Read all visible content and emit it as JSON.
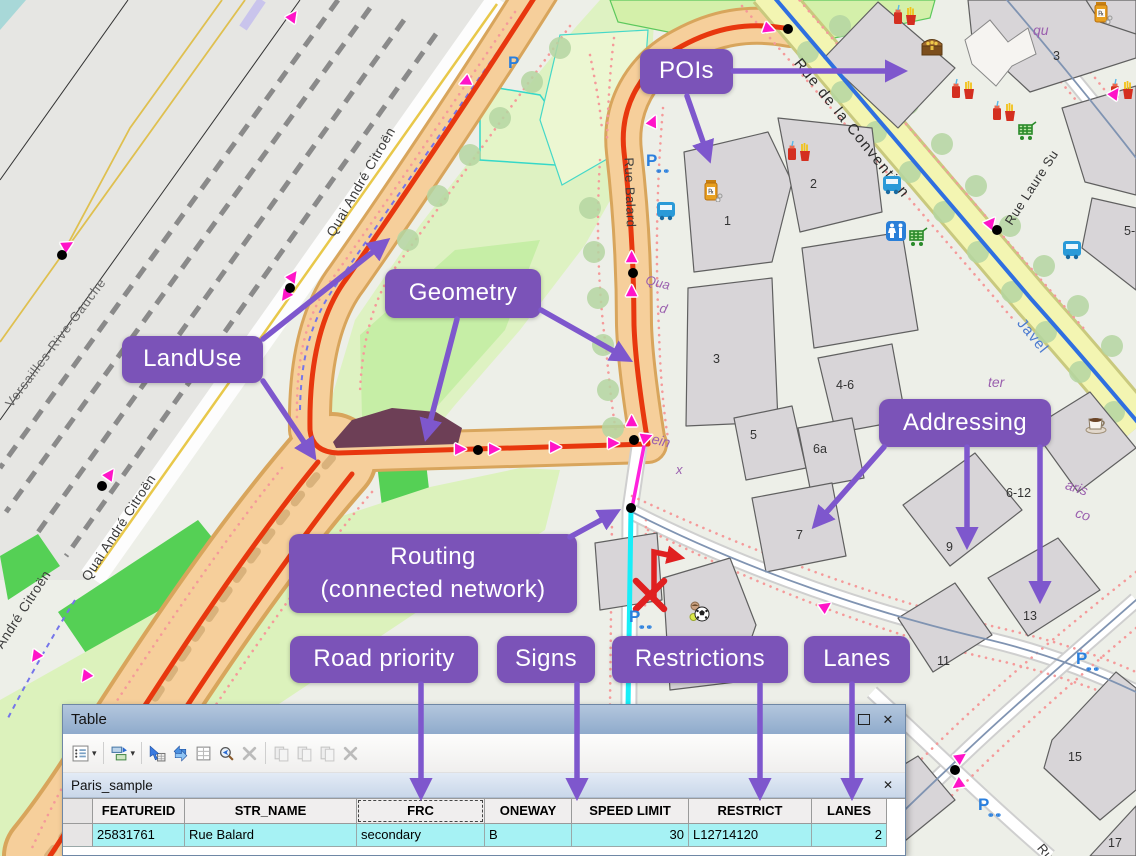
{
  "map": {
    "street_labels": [
      {
        "text": "Versailles-Rive-Gauche",
        "x": 8,
        "y": 398,
        "rot": -53,
        "color": "#6a6a6a",
        "size": 13,
        "ls": 1
      },
      {
        "text": "Quai André Citroën",
        "x": 330,
        "y": 228,
        "rot": -60,
        "color": "#3c3c3c",
        "size": 13.5,
        "ls": 0.5
      },
      {
        "text": "Quai André Citroën",
        "x": 85,
        "y": 572,
        "rot": -57,
        "color": "#3c3c3c",
        "size": 13.5,
        "ls": 0.5
      },
      {
        "text": "Quai André Citroën",
        "x": -20,
        "y": 668,
        "rot": -57,
        "color": "#3c3c3c",
        "size": 13.5,
        "ls": 0.5
      },
      {
        "text": "Rue Balard",
        "x": 629,
        "y": 150,
        "rot": 88,
        "color": "#3c3c3c",
        "size": 13,
        "ls": 0.5
      },
      {
        "text": "Rue de la Convention",
        "x": 797,
        "y": 52,
        "rot": 51,
        "color": "#2a2a2a",
        "size": 15,
        "ls": 1.5
      },
      {
        "text": "Rue Laure Su",
        "x": 1008,
        "y": 216,
        "rot": -57,
        "color": "#333333",
        "size": 13,
        "ls": 0.5
      },
      {
        "text": "Javel",
        "x": 1020,
        "y": 312,
        "rot": 51,
        "color": "#4a7ad0",
        "size": 15,
        "ls": 1
      },
      {
        "text": "Rue",
        "x": 1040,
        "y": 838,
        "rot": 50,
        "color": "#333333",
        "size": 13,
        "ls": 0.5
      },
      {
        "text": "Qua",
        "x": 646,
        "y": 272,
        "rot": 14,
        "color": "#9a5fae",
        "size": 13,
        "italic": true
      },
      {
        "text": "d",
        "x": 660,
        "y": 300,
        "rot": 14,
        "color": "#9a5fae",
        "size": 13,
        "italic": true
      },
      {
        "text": "Pein",
        "x": 643,
        "y": 428,
        "rot": 14,
        "color": "#9a5fae",
        "size": 14,
        "italic": true
      },
      {
        "text": "x",
        "x": 676,
        "y": 462,
        "rot": 0,
        "color": "#9a5fae",
        "size": 13,
        "italic": true
      },
      {
        "text": "ter",
        "x": 988,
        "y": 374,
        "rot": 0,
        "color": "#9a5fae",
        "size": 14,
        "italic": true
      },
      {
        "text": "aris",
        "x": 1066,
        "y": 476,
        "rot": 18,
        "color": "#9a5fae",
        "size": 14,
        "italic": true
      },
      {
        "text": "co",
        "x": 1076,
        "y": 504,
        "rot": 18,
        "color": "#9a5fae",
        "size": 14,
        "italic": true
      },
      {
        "text": "qu",
        "x": 1033,
        "y": 22,
        "rot": 0,
        "color": "#9a5fae",
        "size": 14,
        "italic": true
      }
    ],
    "house_numbers": [
      {
        "text": "1",
        "x": 724,
        "y": 214
      },
      {
        "text": "2",
        "x": 810,
        "y": 177
      },
      {
        "text": "3",
        "x": 713,
        "y": 352
      },
      {
        "text": "3",
        "x": 1053,
        "y": 49
      },
      {
        "text": "4-6",
        "x": 836,
        "y": 378
      },
      {
        "text": "5",
        "x": 750,
        "y": 428
      },
      {
        "text": "6a",
        "x": 813,
        "y": 442
      },
      {
        "text": "7",
        "x": 796,
        "y": 528
      },
      {
        "text": "6-12",
        "x": 1006,
        "y": 486
      },
      {
        "text": "9",
        "x": 946,
        "y": 540
      },
      {
        "text": "13",
        "x": 1023,
        "y": 609
      },
      {
        "text": "11",
        "x": 937,
        "y": 654
      },
      {
        "text": "15",
        "x": 1068,
        "y": 750
      },
      {
        "text": "17",
        "x": 1108,
        "y": 836
      },
      {
        "text": "5-",
        "x": 1124,
        "y": 224
      }
    ],
    "poi_icons": [
      {
        "type": "fast-food-icon",
        "x": 893,
        "y": 4
      },
      {
        "type": "fast-food-icon",
        "x": 951,
        "y": 78
      },
      {
        "type": "fast-food-icon",
        "x": 992,
        "y": 100
      },
      {
        "type": "fast-food-icon",
        "x": 1110,
        "y": 78
      },
      {
        "type": "fast-food-icon",
        "x": 787,
        "y": 140
      },
      {
        "type": "treasure-chest-icon",
        "x": 920,
        "y": 34
      },
      {
        "type": "shopping-cart-icon",
        "x": 1016,
        "y": 118
      },
      {
        "type": "shopping-cart-icon",
        "x": 907,
        "y": 224
      },
      {
        "type": "toilets-icon",
        "x": 884,
        "y": 219
      },
      {
        "type": "bus-icon",
        "x": 654,
        "y": 198
      },
      {
        "type": "bus-icon",
        "x": 880,
        "y": 172
      },
      {
        "type": "bus-icon",
        "x": 1060,
        "y": 237
      },
      {
        "type": "pharmacy-icon",
        "x": 699,
        "y": 178
      },
      {
        "type": "pharmacy-icon",
        "x": 1089,
        "y": 0
      },
      {
        "type": "coffee-icon",
        "x": 1084,
        "y": 411
      },
      {
        "type": "sports-icon",
        "x": 687,
        "y": 600
      }
    ],
    "parking_icons": [
      {
        "x": 508,
        "y": 54,
        "bike": false
      },
      {
        "x": 646,
        "y": 152,
        "bike": true
      },
      {
        "x": 629,
        "y": 608,
        "bike": true
      },
      {
        "x": 1076,
        "y": 650,
        "bike": true
      },
      {
        "x": 978,
        "y": 796,
        "bike": true
      }
    ],
    "oneway_arrows": [
      {
        "x": 295,
        "y": 16,
        "rot": -55
      },
      {
        "x": 467,
        "y": 83,
        "rot": 155
      },
      {
        "x": 70,
        "y": 245,
        "rot": -30
      },
      {
        "x": 112,
        "y": 474,
        "rot": -55
      },
      {
        "x": 295,
        "y": 276,
        "rot": -55
      },
      {
        "x": 288,
        "y": 297,
        "rot": 125
      },
      {
        "x": 38,
        "y": 658,
        "rot": 125
      },
      {
        "x": 88,
        "y": 678,
        "rot": 125
      },
      {
        "x": 463,
        "y": 449,
        "rot": 0
      },
      {
        "x": 497,
        "y": 449,
        "rot": 0
      },
      {
        "x": 558,
        "y": 447,
        "rot": 0
      },
      {
        "x": 616,
        "y": 443,
        "rot": 0
      },
      {
        "x": 649,
        "y": 437,
        "rot": -20
      },
      {
        "x": 633,
        "y": 421,
        "rot": -90
      },
      {
        "x": 633,
        "y": 257,
        "rot": -90
      },
      {
        "x": 633,
        "y": 291,
        "rot": -90
      },
      {
        "x": 655,
        "y": 121,
        "rot": -65
      },
      {
        "x": 772,
        "y": 29,
        "rot": 20
      },
      {
        "x": 993,
        "y": 222,
        "rot": -50
      },
      {
        "x": 1117,
        "y": 93,
        "rot": -55
      },
      {
        "x": 963,
        "y": 757,
        "rot": -35
      },
      {
        "x": 960,
        "y": 786,
        "rot": 145
      },
      {
        "x": 828,
        "y": 606,
        "rot": -35
      }
    ],
    "nodes": [
      {
        "x": 62,
        "y": 255
      },
      {
        "x": 102,
        "y": 486
      },
      {
        "x": 290,
        "y": 288
      },
      {
        "x": 478,
        "y": 450
      },
      {
        "x": 634,
        "y": 440
      },
      {
        "x": 633,
        "y": 273
      },
      {
        "x": 631,
        "y": 508
      },
      {
        "x": 788,
        "y": 29
      },
      {
        "x": 997,
        "y": 230
      },
      {
        "x": 955,
        "y": 770
      }
    ],
    "legend_colors": {
      "selected_link": "#18eef8",
      "edited_link": "#ff22dd",
      "road_geometry": "#e8370e",
      "route": "#2f6fe0",
      "oneway": "#ff14c8"
    }
  },
  "annotations": {
    "box_color": "#7b53b8",
    "arrow_color": "#7e57cd",
    "text_color": "#ffffff",
    "labels": [
      {
        "id": "pois",
        "text": [
          "POIs"
        ],
        "x": 640,
        "y": 49,
        "w": 93,
        "h": 45
      },
      {
        "id": "geometry",
        "text": [
          "Geometry"
        ],
        "x": 385,
        "y": 269,
        "w": 156,
        "h": 49
      },
      {
        "id": "landuse",
        "text": [
          "LandUse"
        ],
        "x": 122,
        "y": 336,
        "w": 141,
        "h": 47
      },
      {
        "id": "addressing",
        "text": [
          "Addressing"
        ],
        "x": 879,
        "y": 399,
        "w": 172,
        "h": 48
      },
      {
        "id": "routing",
        "text": [
          "Routing",
          "(connected network)"
        ],
        "x": 289,
        "y": 534,
        "w": 288,
        "h": 79
      },
      {
        "id": "road-priority",
        "text": [
          "Road priority"
        ],
        "x": 290,
        "y": 636,
        "w": 188,
        "h": 47
      },
      {
        "id": "signs",
        "text": [
          "Signs"
        ],
        "x": 497,
        "y": 636,
        "w": 98,
        "h": 47
      },
      {
        "id": "restrictions",
        "text": [
          "Restrictions"
        ],
        "x": 612,
        "y": 636,
        "w": 176,
        "h": 47
      },
      {
        "id": "lanes",
        "text": [
          "Lanes"
        ],
        "x": 804,
        "y": 636,
        "w": 106,
        "h": 47
      }
    ],
    "arrows": [
      {
        "x1": 733,
        "y1": 71,
        "x2": 900,
        "y2": 71
      },
      {
        "x1": 687,
        "y1": 96,
        "x2": 708,
        "y2": 156
      },
      {
        "x1": 263,
        "y1": 339,
        "x2": 384,
        "y2": 243
      },
      {
        "x1": 263,
        "y1": 381,
        "x2": 312,
        "y2": 454
      },
      {
        "x1": 457,
        "y1": 319,
        "x2": 427,
        "y2": 434
      },
      {
        "x1": 541,
        "y1": 310,
        "x2": 626,
        "y2": 358
      },
      {
        "x1": 884,
        "y1": 447,
        "x2": 817,
        "y2": 523
      },
      {
        "x1": 967,
        "y1": 447,
        "x2": 967,
        "y2": 542
      },
      {
        "x1": 1040,
        "y1": 447,
        "x2": 1040,
        "y2": 596
      },
      {
        "x1": 570,
        "y1": 537,
        "x2": 614,
        "y2": 513
      },
      {
        "x1": 421,
        "y1": 684,
        "x2": 421,
        "y2": 793
      },
      {
        "x1": 577,
        "y1": 684,
        "x2": 577,
        "y2": 793
      },
      {
        "x1": 760,
        "y1": 684,
        "x2": 760,
        "y2": 793
      },
      {
        "x1": 852,
        "y1": 684,
        "x2": 852,
        "y2": 793
      }
    ]
  },
  "table_window": {
    "title": "Table",
    "window_buttons": {
      "restore": "restore-window-button",
      "close_glyph": "✕"
    },
    "toolbar": [
      {
        "name": "table-options-icon",
        "caret": true,
        "enabled": true,
        "group": false
      },
      {
        "name": "related-tables-icon",
        "caret": true,
        "enabled": true,
        "group": true
      },
      {
        "name": "select-by-attributes-icon",
        "enabled": true,
        "group": true
      },
      {
        "name": "switch-selection-icon",
        "enabled": true
      },
      {
        "name": "clear-selection-icon",
        "enabled": true
      },
      {
        "name": "zoom-to-selected-icon",
        "enabled": true
      },
      {
        "name": "delete-selected-icon",
        "enabled": false
      },
      {
        "name": "copy-icon",
        "enabled": false,
        "group": true
      },
      {
        "name": "paste-icon",
        "enabled": false
      },
      {
        "name": "zoom-to-icon",
        "enabled": false
      },
      {
        "name": "delete-icon",
        "enabled": false
      }
    ],
    "tab": {
      "label": "Paris_sample",
      "close_glyph": "✕"
    },
    "columns": [
      {
        "label": "",
        "width": 30,
        "align": "center",
        "selector": true
      },
      {
        "label": "FEATUREID",
        "width": 92,
        "align": "left"
      },
      {
        "label": "STR_NAME",
        "width": 172,
        "align": "left"
      },
      {
        "label": "FRC",
        "width": 128,
        "align": "left",
        "focused": true
      },
      {
        "label": "ONEWAY",
        "width": 87,
        "align": "left"
      },
      {
        "label": "SPEED LIMIT",
        "width": 117,
        "align": "right"
      },
      {
        "label": "RESTRICT",
        "width": 123,
        "align": "left"
      },
      {
        "label": "LANES",
        "width": 75,
        "align": "right"
      }
    ],
    "rows": [
      [
        "",
        "25831761",
        "Rue Balard",
        "secondary",
        "B",
        "30",
        "L12714120",
        "2"
      ]
    ],
    "selected_row_color": "#a6f2f4"
  }
}
